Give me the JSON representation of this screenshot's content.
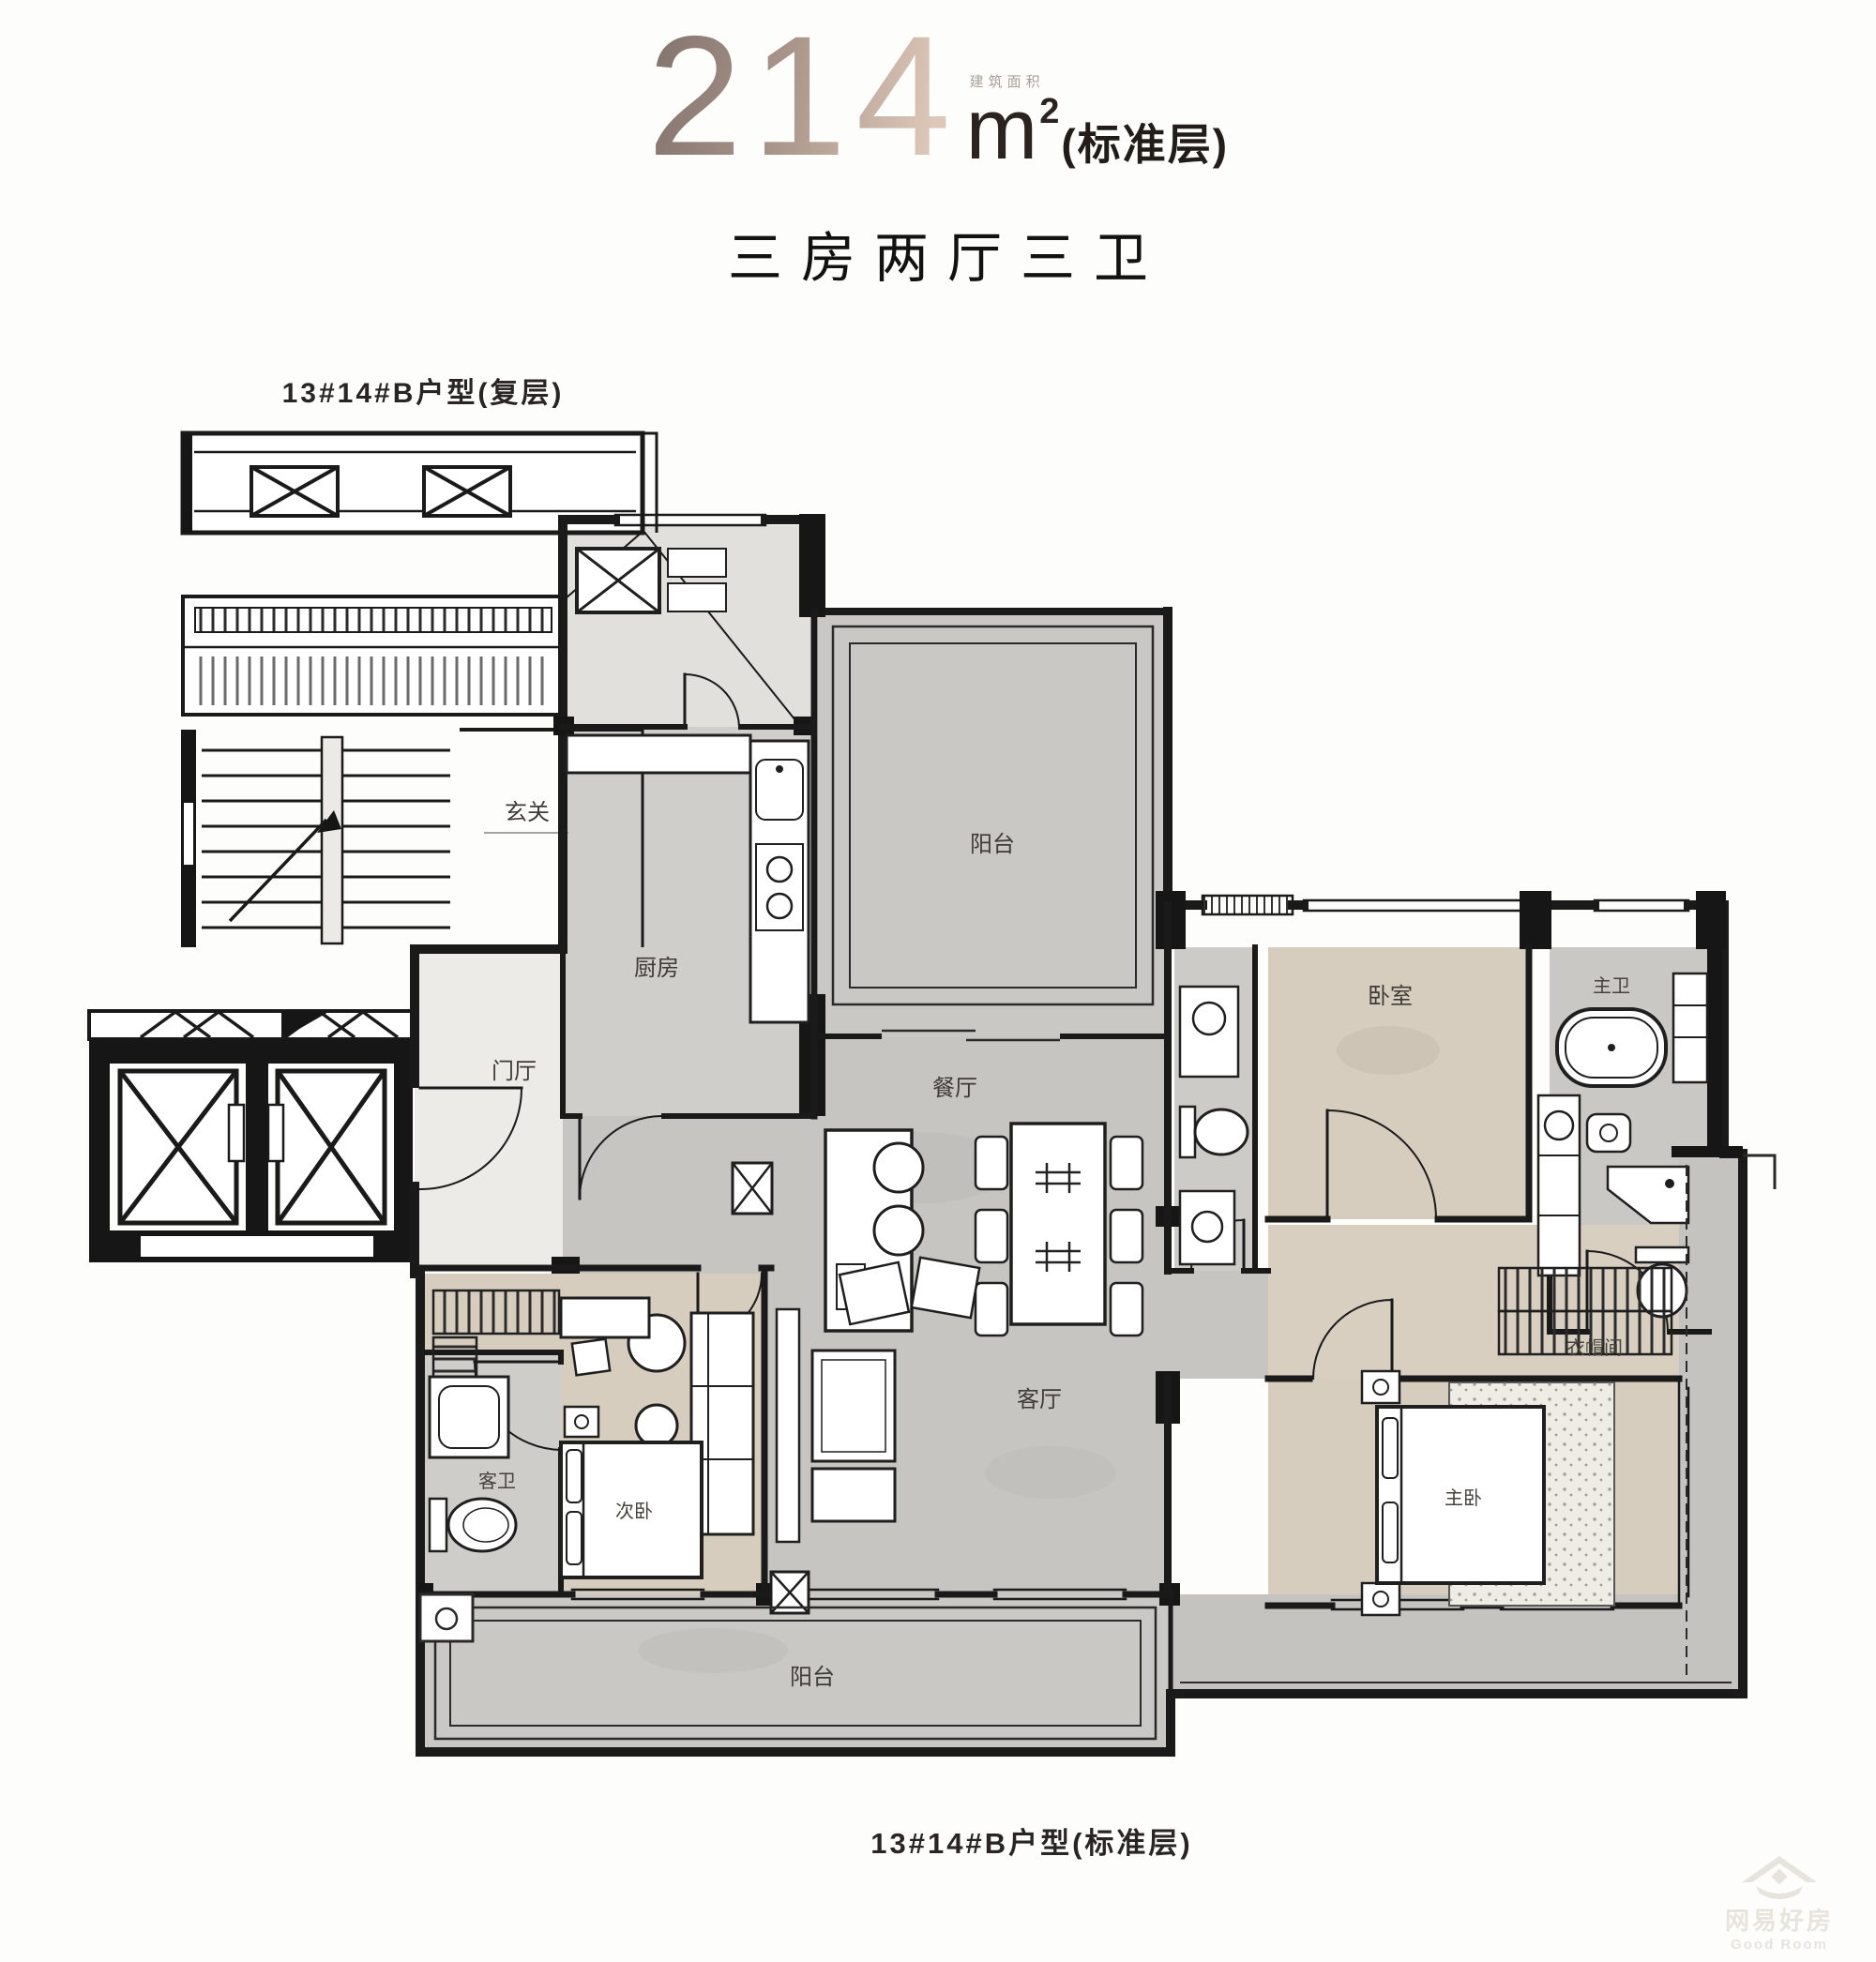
{
  "header": {
    "area_number": "214",
    "area_unit": "m",
    "area_sup": "2",
    "area_note": "(标准层)",
    "area_small_note": "建筑面积",
    "subtitle": "三房两厅三卫"
  },
  "captions": {
    "top": "13#14#B户型(复层)",
    "bottom": "13#14#B户型(标准层)"
  },
  "rooms": {
    "foyer": "玄关",
    "hall": "门厅",
    "kitchen": "厨房",
    "balcony_north": "阳台",
    "dining": "餐厅",
    "living": "客厅",
    "bedroom2": "卧室",
    "master_bath": "主卫",
    "closet": "衣帽间",
    "master_bedroom": "主卧",
    "bedroom1": "次卧",
    "bath1": "客卫",
    "balcony_south": "阳台"
  },
  "watermark": {
    "cn": "网易好房",
    "en": "Good Room"
  },
  "colors": {
    "num_dark": "#857670",
    "num_mid": "#ab968b",
    "num_light": "#dcc7b8",
    "line": "#1a1a1a",
    "floor_gray": "#c6c5c1",
    "floor_beige": "#d7cdbe",
    "floor_light": "#edebe7"
  }
}
